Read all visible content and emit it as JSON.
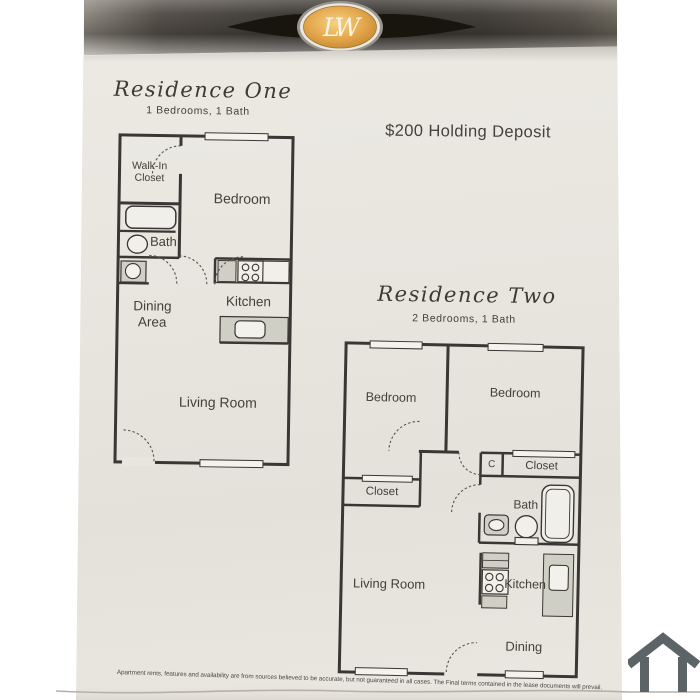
{
  "brand": {
    "monogram": "LW"
  },
  "header": {
    "deposit": "$200 Holding Deposit"
  },
  "residence_one": {
    "title": "Residence One",
    "subtitle": "1 Bedrooms, 1 Bath",
    "rooms": {
      "walk_in_1": "Walk-In",
      "walk_in_2": "Closet",
      "bedroom": "Bedroom",
      "bath": "Bath",
      "dining_1": "Dining",
      "dining_2": "Area",
      "kitchen": "Kitchen",
      "living_room": "Living Room"
    }
  },
  "residence_two": {
    "title": "Residence Two",
    "subtitle": "2 Bedrooms, 1 Bath",
    "rooms": {
      "bedroom_left": "Bedroom",
      "bedroom_right": "Bedroom",
      "closet_c": "C",
      "closet_right": "Closet",
      "closet_left": "Closet",
      "bath": "Bath",
      "living_room": "Living Room",
      "kitchen": "Kitchen",
      "dining": "Dining"
    }
  },
  "footer": {
    "disclaimer": "Apartment rents, features and availability are from sources believed to be accurate, but not guaranteed in all cases. The Final terms contained in the lease documents will prevail."
  },
  "colors": {
    "wall": "#3a3633",
    "counter": "#d0cfc6",
    "paper": "#e9e6e0",
    "band_dark": "#3b3732",
    "logo_gold": "#dda449",
    "house_icon": "#5c6468"
  }
}
